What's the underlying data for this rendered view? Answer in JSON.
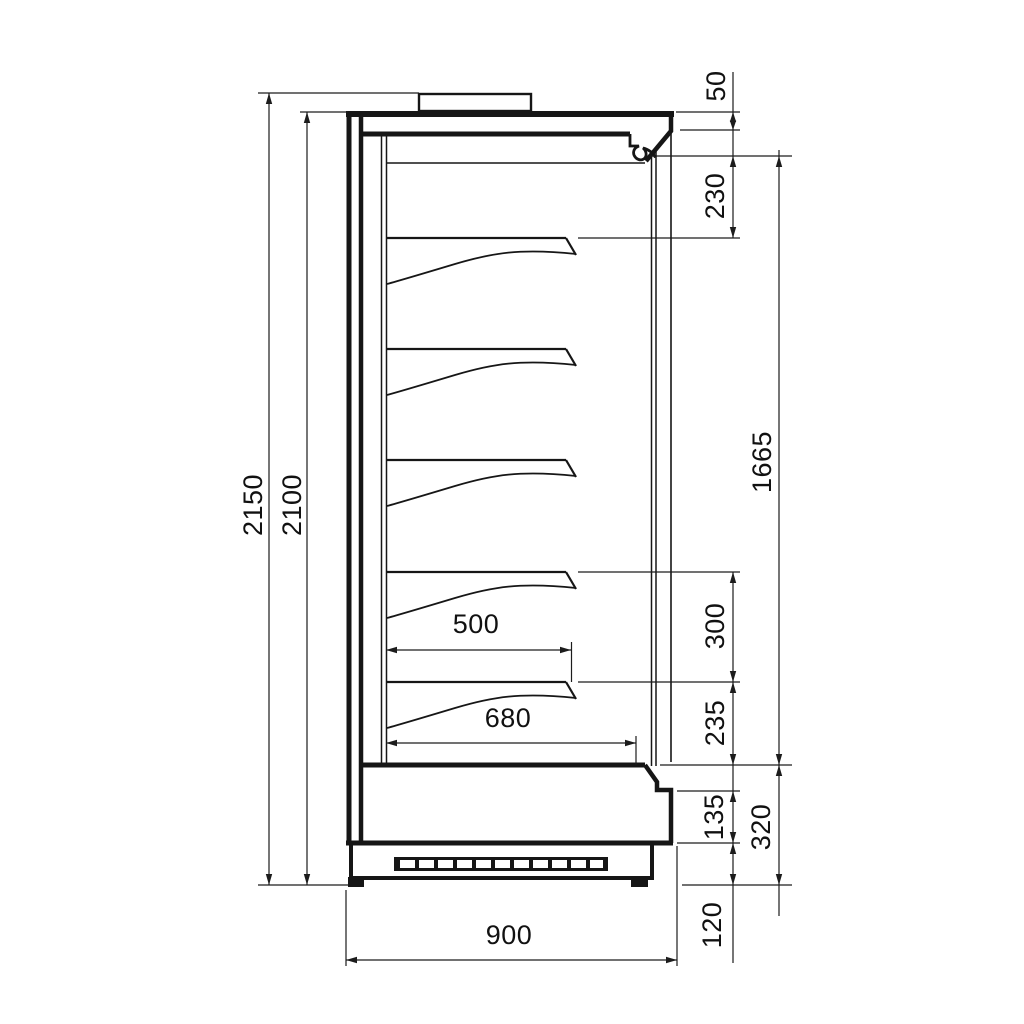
{
  "drawing": {
    "description": "Technical side-section dimension drawing of a refrigerated multideck display cabinet with five shelves, rear duct, glass front, ventilation grille plinth and top spacer",
    "background": "#ffffff",
    "line_color": "#161616",
    "units": "mm"
  },
  "labels": {
    "overall_height": "2150",
    "cabinet_height": "2100",
    "top_offset": "50",
    "canopy_zone": "230",
    "opening_height": "1665",
    "shelf_pitch": "300",
    "deck_to_shelf": "235",
    "lower_front_panel": "135",
    "base_section": "320",
    "plinth_height": "120",
    "shelf_depth": "500",
    "deck_depth": "680",
    "overall_depth": "900"
  }
}
